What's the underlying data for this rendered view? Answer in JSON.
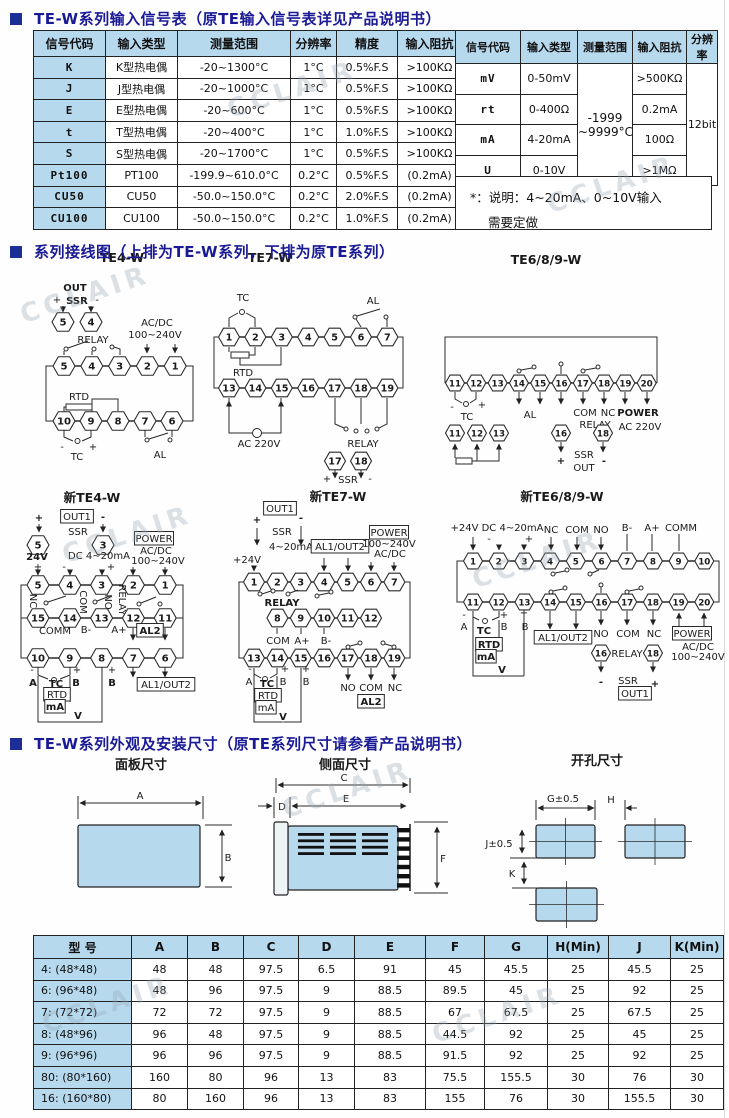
{
  "watermark": "CCLAIR",
  "sections": [
    "TE-W系列输入信号表（原TE输入信号表详见产品说明书）",
    "系列接线图（上排为TE-W系列，下排为原TE系列）",
    "TE-W系列外观及安装尺寸（原TE系列尺寸请参看产品说明书）"
  ],
  "signal_table_left": {
    "headers": [
      "信号代码",
      "输入类型",
      "测量范围",
      "分辨率",
      "精度",
      "输入阻抗"
    ],
    "rows": [
      [
        "K",
        "K型热电偶",
        "-20~1300°C",
        "1°C",
        "0.5%F.S",
        ">100KΩ"
      ],
      [
        "J",
        "J型热电偶",
        "-20~1000°C",
        "1°C",
        "0.5%F.S",
        ">100KΩ"
      ],
      [
        "E",
        "E型热电偶",
        "-20~600°C",
        "1°C",
        "0.5%F.S",
        ">100KΩ"
      ],
      [
        "t",
        "T型热电偶",
        "-20~400°C",
        "1°C",
        "1.0%F.S",
        ">100KΩ"
      ],
      [
        "S",
        "S型热电偶",
        "-20~1700°C",
        "1°C",
        "0.5%F.S",
        ">100KΩ"
      ],
      [
        "Pt100",
        "PT100",
        "-199.9~610.0°C",
        "0.2°C",
        "0.5%F.S",
        "(0.2mA)"
      ],
      [
        "CU50",
        "CU50",
        "-50.0~150.0°C",
        "0.2°C",
        "2.0%F.S",
        "(0.2mA)"
      ],
      [
        "CU100",
        "CU100",
        "-50.0~150.0°C",
        "0.2°C",
        "1.0%F.S",
        "(0.2mA)"
      ]
    ]
  },
  "signal_table_right": {
    "headers": [
      "信号代码",
      "输入类型",
      "测量范围",
      "输入阻抗",
      "分辨率"
    ],
    "range_merged": "-1999 ~9999°C",
    "resolution_merged": "12bit",
    "rows": [
      [
        "mV",
        "0-50mV",
        ">500KΩ"
      ],
      [
        "rt",
        "0-400Ω",
        "0.2mA"
      ],
      [
        "mA",
        "4-20mA",
        "100Ω"
      ],
      [
        "U",
        "0-10V",
        ">1MΩ"
      ]
    ],
    "note_line1": "*：说明：4~20mA、0~10V输入",
    "note_line2": "需要定做"
  },
  "diagrams": [
    {
      "title": "TE4-W",
      "rows": [
        [
          "5",
          "4",
          "3",
          "2",
          "1"
        ],
        [
          "10",
          "9",
          "8",
          "7",
          "6"
        ]
      ],
      "aux": [
        [
          "5",
          "4"
        ]
      ],
      "labels": [
        "OUT",
        "+",
        "SSR",
        "-",
        "RELAY",
        "AC/DC",
        "100~240V",
        "RTD",
        "-",
        "+",
        "TC",
        "AL"
      ]
    },
    {
      "title": "TE7-W",
      "rows": [
        [
          "1",
          "2",
          "3",
          "4",
          "5",
          "6",
          "7"
        ],
        [
          "13",
          "14",
          "15",
          "16",
          "17",
          "18",
          "19"
        ]
      ],
      "aux": [
        [
          "17",
          "18"
        ]
      ],
      "labels": [
        "TC",
        "AL",
        "RTD",
        "AC 220V",
        "RELAY",
        "+",
        "SSR",
        "-"
      ]
    },
    {
      "title": "TE6/8/9-W",
      "rows": [
        [
          "11",
          "12",
          "13",
          "14",
          "15",
          "16",
          "17",
          "18",
          "19",
          "20"
        ]
      ],
      "aux": [
        [
          "11",
          "12",
          "13"
        ],
        [
          "16"
        ],
        [
          "18"
        ]
      ],
      "labels": [
        "-",
        "+",
        "TC",
        "AL",
        "COM",
        "NC",
        "RELAY",
        "POWER",
        "AC 220V",
        "+",
        "SSR",
        "OUT",
        "-"
      ]
    },
    {
      "title": "新TE4-W",
      "rows": [
        [
          "5",
          "4",
          "3",
          "2",
          "1"
        ],
        [
          "15",
          "14",
          "13",
          "12",
          "11"
        ],
        [
          "10",
          "9",
          "8",
          "7",
          "6"
        ]
      ],
      "aux": [
        [
          "5"
        ],
        [
          "3"
        ]
      ],
      "labels": [
        "+",
        "OUT1",
        "-",
        "SSR",
        "24V",
        "DC 4~20mA",
        "POWER",
        "AC/DC",
        "100~240V",
        "+",
        "-",
        "+",
        "NC",
        "COM",
        "NO",
        "RELAY",
        "COMM",
        "B-",
        "A+",
        "AL2",
        "-",
        "+",
        "+",
        "A",
        "TC",
        "B",
        "B",
        "RTD",
        "mA",
        "V",
        "AL1/OUT2"
      ]
    },
    {
      "title": "新TE7-W",
      "rows": [
        [
          "1",
          "2",
          "3",
          "4",
          "5",
          "6",
          "7"
        ],
        [
          "8",
          "9",
          "10",
          "11",
          "12"
        ],
        [
          "13",
          "14",
          "15",
          "16",
          "17",
          "18",
          "19"
        ]
      ],
      "aux": [],
      "labels": [
        "OUT1",
        "+",
        "-",
        "SSR",
        "4~20mA",
        "AL1/OUT2",
        "POWER",
        "100~240V",
        "AC/DC",
        "+24V",
        "RELAY",
        "COM",
        "A+",
        "B-",
        "-",
        "+",
        "+",
        "A",
        "TC",
        "B",
        "B",
        "RTD",
        "mA",
        "V",
        "NO",
        "COM",
        "NC",
        "AL2"
      ]
    },
    {
      "title": "新TE6/8/9-W",
      "rows": [
        [
          "1",
          "2",
          "3",
          "4",
          "5",
          "6",
          "7",
          "8",
          "9",
          "10"
        ],
        [
          "11",
          "12",
          "13",
          "14",
          "15",
          "16",
          "17",
          "18",
          "19",
          "20"
        ]
      ],
      "aux": [
        [
          "16"
        ],
        [
          "18"
        ]
      ],
      "labels": [
        "+24V DC 4~20mA",
        "-",
        "+",
        "NC",
        "COM",
        "NO",
        "B-",
        "A+",
        "COMM",
        "-",
        "+",
        "A",
        "TC",
        "B",
        "+",
        "B",
        "AL1/OUT2",
        "NO",
        "COM",
        "NC",
        "POWER",
        "AC/DC",
        "100~240V",
        "RTD",
        "mA",
        "V",
        "RELAY",
        "-",
        "SSR",
        "+",
        "OUT1"
      ]
    }
  ],
  "dims": {
    "panel": "面板尺寸",
    "side": "侧面尺寸",
    "cutout": "开孔尺寸",
    "A": "A",
    "B": "B",
    "C": "C",
    "D": "D",
    "E": "E",
    "F": "F",
    "G": "G±0.5",
    "H": "H",
    "J": "J±0.5",
    "K": "K"
  },
  "size_table": {
    "headers": [
      "型  号",
      "A",
      "B",
      "C",
      "D",
      "E",
      "F",
      "G",
      "H(Min)",
      "J",
      "K(Min)"
    ],
    "rows": [
      [
        "4: (48*48)",
        "48",
        "48",
        "97.5",
        "6.5",
        "91",
        "45",
        "45.5",
        "25",
        "45.5",
        "25"
      ],
      [
        "6: (96*48)",
        "48",
        "96",
        "97.5",
        "9",
        "88.5",
        "89.5",
        "45",
        "25",
        "92",
        "25"
      ],
      [
        "7: (72*72)",
        "72",
        "72",
        "97.5",
        "9",
        "88.5",
        "67",
        "67.5",
        "25",
        "67.5",
        "25"
      ],
      [
        "8: (48*96)",
        "96",
        "48",
        "97.5",
        "9",
        "88.5",
        "44.5",
        "92",
        "25",
        "45",
        "25"
      ],
      [
        "9: (96*96)",
        "96",
        "96",
        "97.5",
        "9",
        "88.5",
        "91.5",
        "92",
        "25",
        "92",
        "25"
      ],
      [
        "80: (80*160)",
        "160",
        "80",
        "96",
        "13",
        "83",
        "75.5",
        "155.5",
        "30",
        "76",
        "30"
      ],
      [
        "16: (160*80)",
        "80",
        "160",
        "96",
        "13",
        "83",
        "155",
        "76",
        "30",
        "155.5",
        "30"
      ]
    ]
  }
}
